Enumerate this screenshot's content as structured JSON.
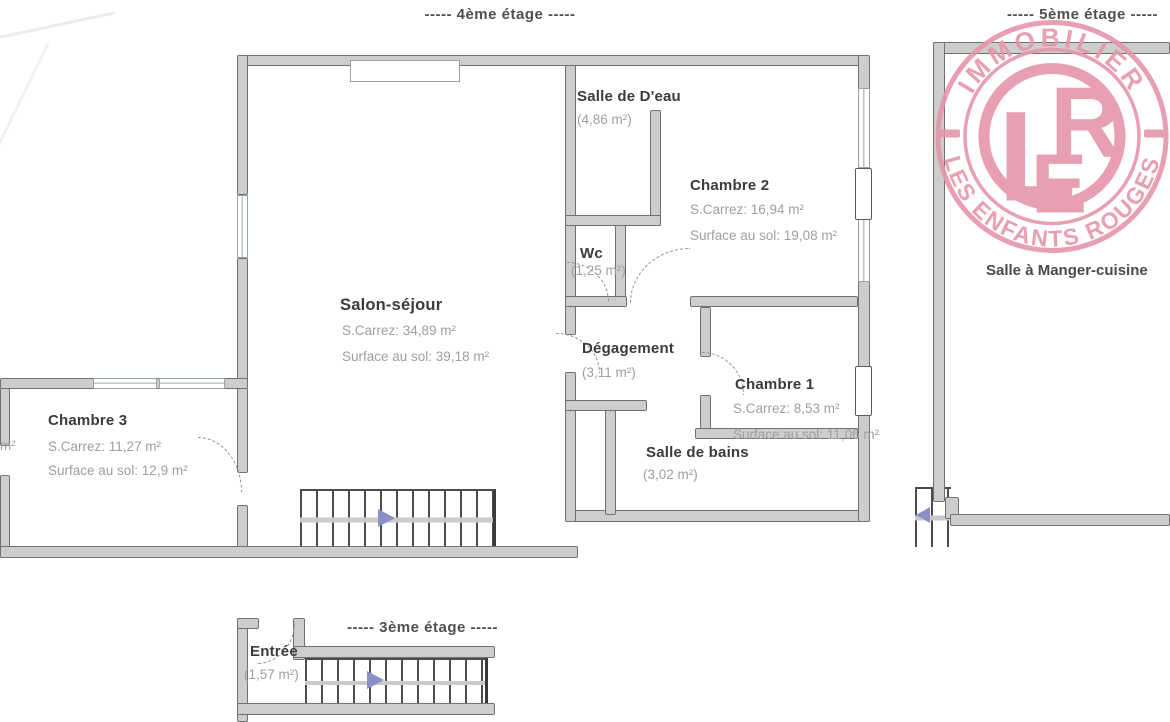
{
  "floors": {
    "fourth_label": "----- 4ème étage -----",
    "fifth_label": "----- 5ème étage -----",
    "third_label": "----- 3ème étage -----"
  },
  "rooms": {
    "salle_deau": {
      "name": "Salle de D'eau",
      "area": "(4,86 m²)"
    },
    "chambre2": {
      "name": "Chambre 2",
      "carrez": "S.Carrez: 16,94 m²",
      "sol": "Surface au sol: 19,08 m²"
    },
    "wc": {
      "name": "Wc",
      "area": "(1,25 m²)"
    },
    "salon": {
      "name": "Salon-séjour",
      "carrez": "S.Carrez: 34,89 m²",
      "sol": "Surface au sol: 39,18 m²"
    },
    "degagement": {
      "name": "Dégagement",
      "area": "(3,11 m²)"
    },
    "chambre1": {
      "name": "Chambre 1",
      "carrez": "S.Carrez: 8,53 m²",
      "sol": "Surface au sol: 11,06 m²"
    },
    "salle_de_bains": {
      "name": "Salle de bains",
      "area": "(3,02 m²)"
    },
    "chambre3": {
      "name": "Chambre 3",
      "carrez": "S.Carrez: 11,27 m²",
      "sol": "Surface au sol: 12,9 m²"
    },
    "salle_a_manger": {
      "name": "Salle à Manger-cuisine"
    },
    "entree": {
      "name": "Entrée",
      "area": "(1,57 m²)"
    }
  },
  "fragments": {
    "left_area_unit": "m²"
  },
  "stamp": {
    "top_text": "IMMOBILIER",
    "bottom_text": "LES ENFANTS ROUGES",
    "letter_l": "L",
    "letter_e": "E",
    "letter_r": "R"
  },
  "colors": {
    "wall_fill": "#cdcdcd",
    "wall_edge": "#707070",
    "stair_arrow_blue": "#8890c5",
    "room_name_text": "#3b3b3b",
    "area_text": "#9e9e9e",
    "stamp_pink": "#e795aa"
  }
}
